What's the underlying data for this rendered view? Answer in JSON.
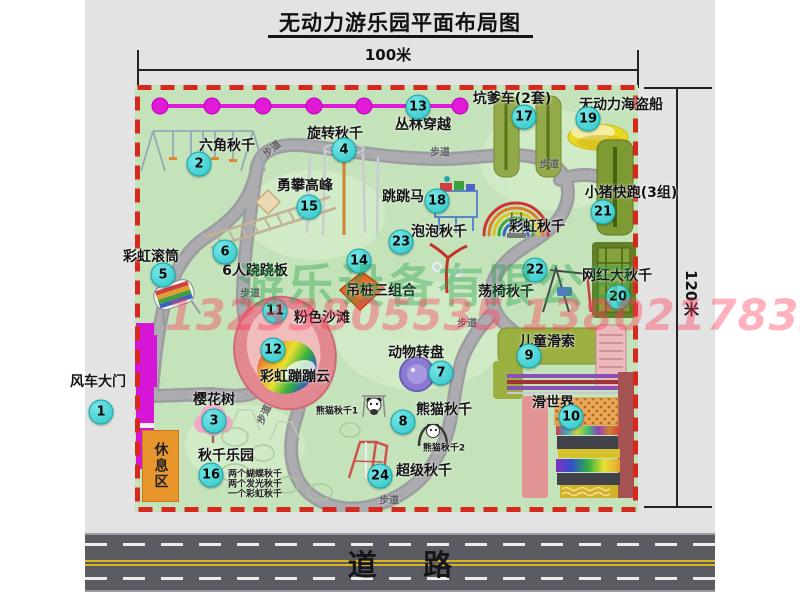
{
  "title": "无动力游乐园平面布局图",
  "dimensions": {
    "width_label": "100米",
    "height_label": "120米"
  },
  "road_label": "道路",
  "rest_area_label": "休息区",
  "path_sign_label": "步道",
  "watermark": {
    "company_text": "游乐设备有限公司",
    "phone_text": "13233805535 13802178333"
  },
  "colors": {
    "map_green": "#c4e3ba",
    "border_red": "#d6281c",
    "marker_cyan": "#3ad1d1",
    "chain_magenta": "#e01ad6",
    "gate_magenta": "#d616d6",
    "rest_area_orange": "#e8952c",
    "road_gray": "#5b5b63"
  },
  "attractions": [
    {
      "num": "1",
      "name": "风车大门"
    },
    {
      "num": "2",
      "name": "六角秋千"
    },
    {
      "num": "3",
      "name": "樱花树"
    },
    {
      "num": "4",
      "name": "旋转秋千"
    },
    {
      "num": "5",
      "name": "彩虹滚筒"
    },
    {
      "num": "6",
      "name": "6人跷跷板"
    },
    {
      "num": "7",
      "name": "动物转盘"
    },
    {
      "num": "8",
      "name": "熊猫秋千"
    },
    {
      "num": "9",
      "name": "儿童滑索"
    },
    {
      "num": "10",
      "name": "滑世界"
    },
    {
      "num": "11",
      "name": "粉色沙滩"
    },
    {
      "num": "12",
      "name": "彩虹蹦蹦云"
    },
    {
      "num": "13",
      "name": "丛林穿越"
    },
    {
      "num": "14",
      "name": "吊桩三组合"
    },
    {
      "num": "15",
      "name": "勇攀高峰"
    },
    {
      "num": "16",
      "name": "秋千乐园"
    },
    {
      "num": "17",
      "name": "坑爹车(2套)"
    },
    {
      "num": "18",
      "name": "跳跳马"
    },
    {
      "num": "19",
      "name": "无动力海盗船"
    },
    {
      "num": "20",
      "name": "网红大秋千"
    },
    {
      "num": "21",
      "name": "小猪快跑(3组)"
    },
    {
      "num": "22",
      "name": "荡椅秋千"
    },
    {
      "num": "23",
      "name": "泡泡秋千"
    },
    {
      "num": "24",
      "name": "超级秋千"
    }
  ],
  "unnumbered_labels": {
    "rainbow_swing": "彩虹秋千",
    "panda_swing_1": "熊猫秋千1",
    "panda_swing_2": "熊猫秋千2"
  },
  "swing_park_notes": [
    "两个蝴蝶秋千",
    "两个发光秋千",
    "一个彩虹秋千"
  ]
}
